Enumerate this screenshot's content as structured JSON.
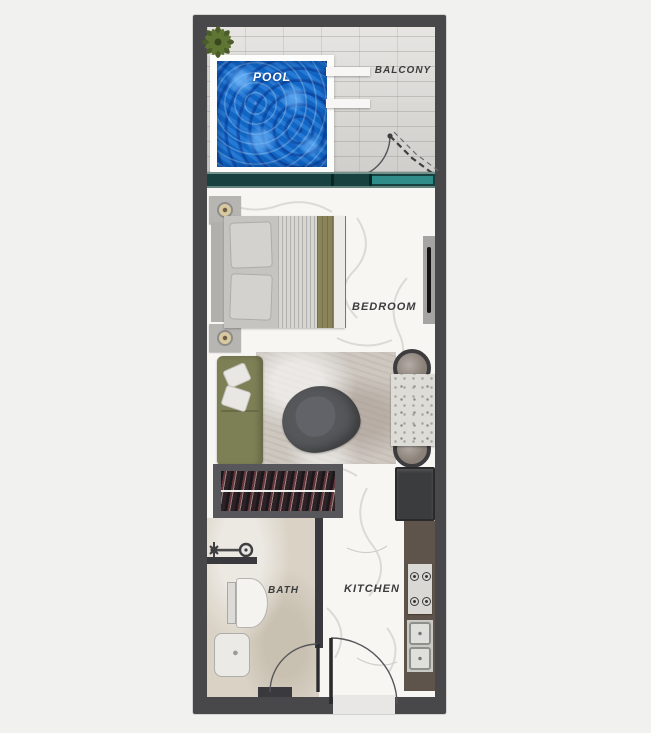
{
  "plan": {
    "type": "studio-apartment-floorplan",
    "labels": {
      "pool": "POOL",
      "balcony": "BALCONY",
      "bedroom": "BEDROOM",
      "bath": "BATH",
      "kitchen": "KITCHEN"
    },
    "colors": {
      "outer_wall": "#48484b",
      "interior_wall": "#3a3a3e",
      "pool_water": "#1166c4",
      "pool_deck": "#fcfcfb",
      "balcony_floor": "#d9d7d3",
      "window_glass_dark": "#16413e",
      "window_glass_light": "#2f8c88",
      "interior_floor": "#f7f6f3",
      "bath_floor": "#d9d2c5",
      "sofa": "#7d7f55",
      "bed_blanket_stripe": "#8b8459",
      "rug": "#cdc7c0",
      "lounge_chair": "#55575a",
      "kitchen_counter": "#5e544b",
      "fridge": "#3b3c3e",
      "label_text": "#3c3c3e",
      "pool_label_text": "#ffffff"
    },
    "rooms": [
      {
        "name": "balcony",
        "label": "BALCONY",
        "features": [
          "swimming-pool",
          "palm-plant",
          "pool-steps",
          "bifold-door"
        ]
      },
      {
        "name": "bedroom",
        "label": "BEDROOM",
        "features": [
          "double-bed",
          "headboard",
          "nightstand-with-lamp",
          "nightstand-with-lamp",
          "wall-tv",
          "sliding-window"
        ]
      },
      {
        "name": "living-area",
        "features": [
          "sofa",
          "throw-pillows",
          "rug",
          "lounge-chair",
          "dining-table",
          "dining-chair",
          "dining-chair",
          "wardrobe"
        ]
      },
      {
        "name": "bath",
        "label": "BATH",
        "features": [
          "shower-head",
          "partition-wall",
          "toilet",
          "vanity-sink",
          "swing-door"
        ]
      },
      {
        "name": "kitchen",
        "label": "KITCHEN",
        "features": [
          "fridge",
          "counter",
          "cooktop",
          "double-sink"
        ]
      },
      {
        "name": "entry",
        "features": [
          "entry-door",
          "threshold"
        ]
      }
    ]
  }
}
